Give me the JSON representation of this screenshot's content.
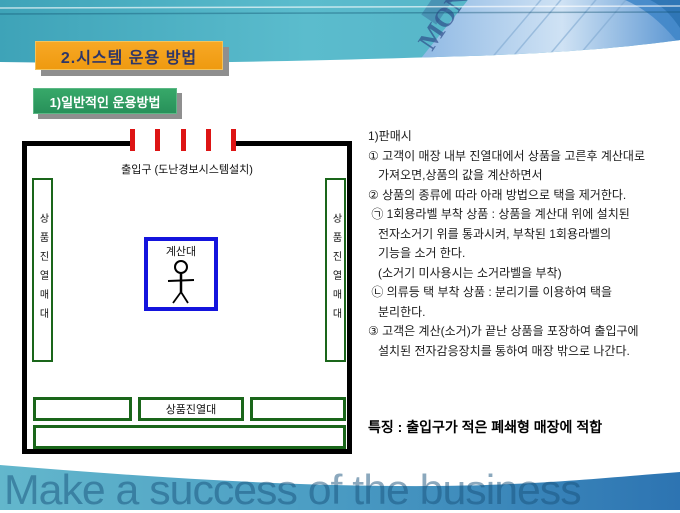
{
  "slide": {
    "title": "2.시스템 운용 방법",
    "subtitle": "1)일반적인 운용방법",
    "watermark": "Make a success of the business",
    "money_label": "MONEY"
  },
  "diagram": {
    "entrance_label": "출입구 (도난경보시스템설치)",
    "left_shelf_label": "상품진열매대",
    "right_shelf_label": "상품진열매대",
    "checkout_label": "계산대",
    "bottom_shelf_label": "상품진열대"
  },
  "body": {
    "lines": [
      "1)판매시",
      "① 고객이 매장 내부 진열대에서 상품을 고른후 계산대로",
      "   가져오면,상품의 값을 계산하면서",
      "② 상품의 종류에 따라 아래 방법으로 택을 제거한다.",
      " ㉠ 1회용라벨 부착 상품 : 상품을 계산대 위에 설치된",
      "   전자소거기 위를 통과시켜, 부착된 1회용라벨의",
      "   기능을 소거 한다.",
      "   (소거기 미사용시는 소거라벨을 부착)",
      " ㉡ 의류등 택 부착 상품 : 분리기를 이용하여 택을",
      "   분리한다.",
      "③ 고객은 계산(소거)가 끝난 상품을 포장하여 출입구에",
      "   설치된 전자감응장치를 통하여 매장 밖으로 나간다."
    ],
    "feature": "특징 : 출입구가 적은 폐쇄형 매장에 적합"
  },
  "colors": {
    "title_bg": "#f3a01a",
    "title_text": "#2e3668",
    "subtitle_bg": "#2e9b60",
    "shelf_green": "#1a661a",
    "checkout_blue": "#1414dd",
    "sensor_red": "#dd1414",
    "header_teal": "#47b0c2",
    "footer_blue": "#2d74b4"
  }
}
